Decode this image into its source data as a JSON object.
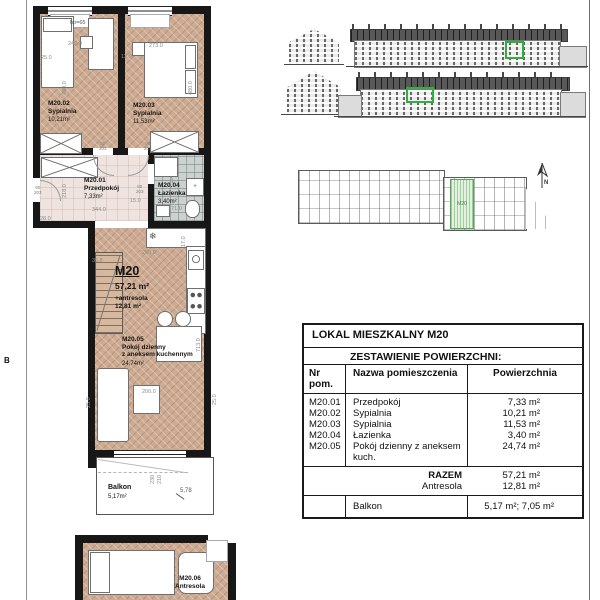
{
  "colors": {
    "wall": "#171717",
    "floor_wood": "#cdab92",
    "floor_hall": "#eee3de",
    "floor_bath": "#ccd2cf",
    "highlight_green": "#2eb13c"
  },
  "plan": {
    "section_marker": "B",
    "unit": {
      "id": "M20",
      "area": "57,21 m²",
      "antresola_label": "+antresola",
      "antresola_area": "12,81 m²"
    },
    "rooms": {
      "r01": {
        "id": "M20.01",
        "name": "Przedpokój",
        "area": "7,33m²"
      },
      "r02": {
        "id": "M20.02",
        "name": "Sypialnia",
        "area": "10,21m²"
      },
      "r03": {
        "id": "M20.03",
        "name": "Sypialnia",
        "area": "11,53m²"
      },
      "r04": {
        "id": "M20.04",
        "name": "Łazienka",
        "area": "3,40m²"
      },
      "r05": {
        "id": "M20.05",
        "name_line1": "Pokój dzienny",
        "name_line2": "z aneksem kuchennym",
        "area": "24,74m²"
      },
      "r06": {
        "id": "M20.06",
        "name": "Antresola"
      }
    },
    "balcony": {
      "name": "Balkon",
      "area": "5,17m²",
      "level": "5,78",
      "dim_a": "230",
      "dim_b": "210"
    },
    "dims": {
      "hp": "hp=65",
      "d242": "242.0",
      "d25_1": "25.0",
      "d273": "273.0",
      "d12": "12.0",
      "d430": "430.0",
      "d480": "480.0",
      "door80_w": "80",
      "door80_h": "203",
      "door90_w": "90",
      "door90_h": "203",
      "d344": "344.0",
      "d28": "28.0",
      "d218": "218.0",
      "d171": "171.0",
      "d15": "15.0",
      "d17": "17.0",
      "d250": "250.0",
      "d35": "35.8",
      "d713": "713.0",
      "d200": "200.0",
      "d25_2": "25.0",
      "d25_3": "25.0"
    }
  },
  "key_plan": {
    "unit_label": "M20",
    "north_label": "N"
  },
  "icons": {
    "fridge": "❄"
  },
  "table": {
    "title": "LOKAL MIESZKALNY M20",
    "subtitle": "ZESTAWIENIE POWIERZCHNI:",
    "columns": [
      "Nr pom.",
      "Nazwa pomieszczenia",
      "Powierzchnia"
    ],
    "rows": [
      {
        "nr": "M20.01",
        "name": "Przedpokój",
        "area": "7,33 m²"
      },
      {
        "nr": "M20.02",
        "name": "Sypialnia",
        "area": "10,21 m²"
      },
      {
        "nr": "M20.03",
        "name": "Sypialnia",
        "area": "11,53 m²"
      },
      {
        "nr": "M20.04",
        "name": "Łazienka",
        "area": "3,40 m²"
      },
      {
        "nr": "M20.05",
        "name": "Pokój dzienny z aneksem kuch.",
        "area": "24,74 m²"
      }
    ],
    "summary": [
      {
        "label": "RAZEM",
        "value": "57,21 m²"
      },
      {
        "label": "Antresola",
        "value": "12,81 m²"
      }
    ],
    "balcony": {
      "label": "Balkon",
      "value": "5,17 m²; 7,05 m²"
    }
  }
}
